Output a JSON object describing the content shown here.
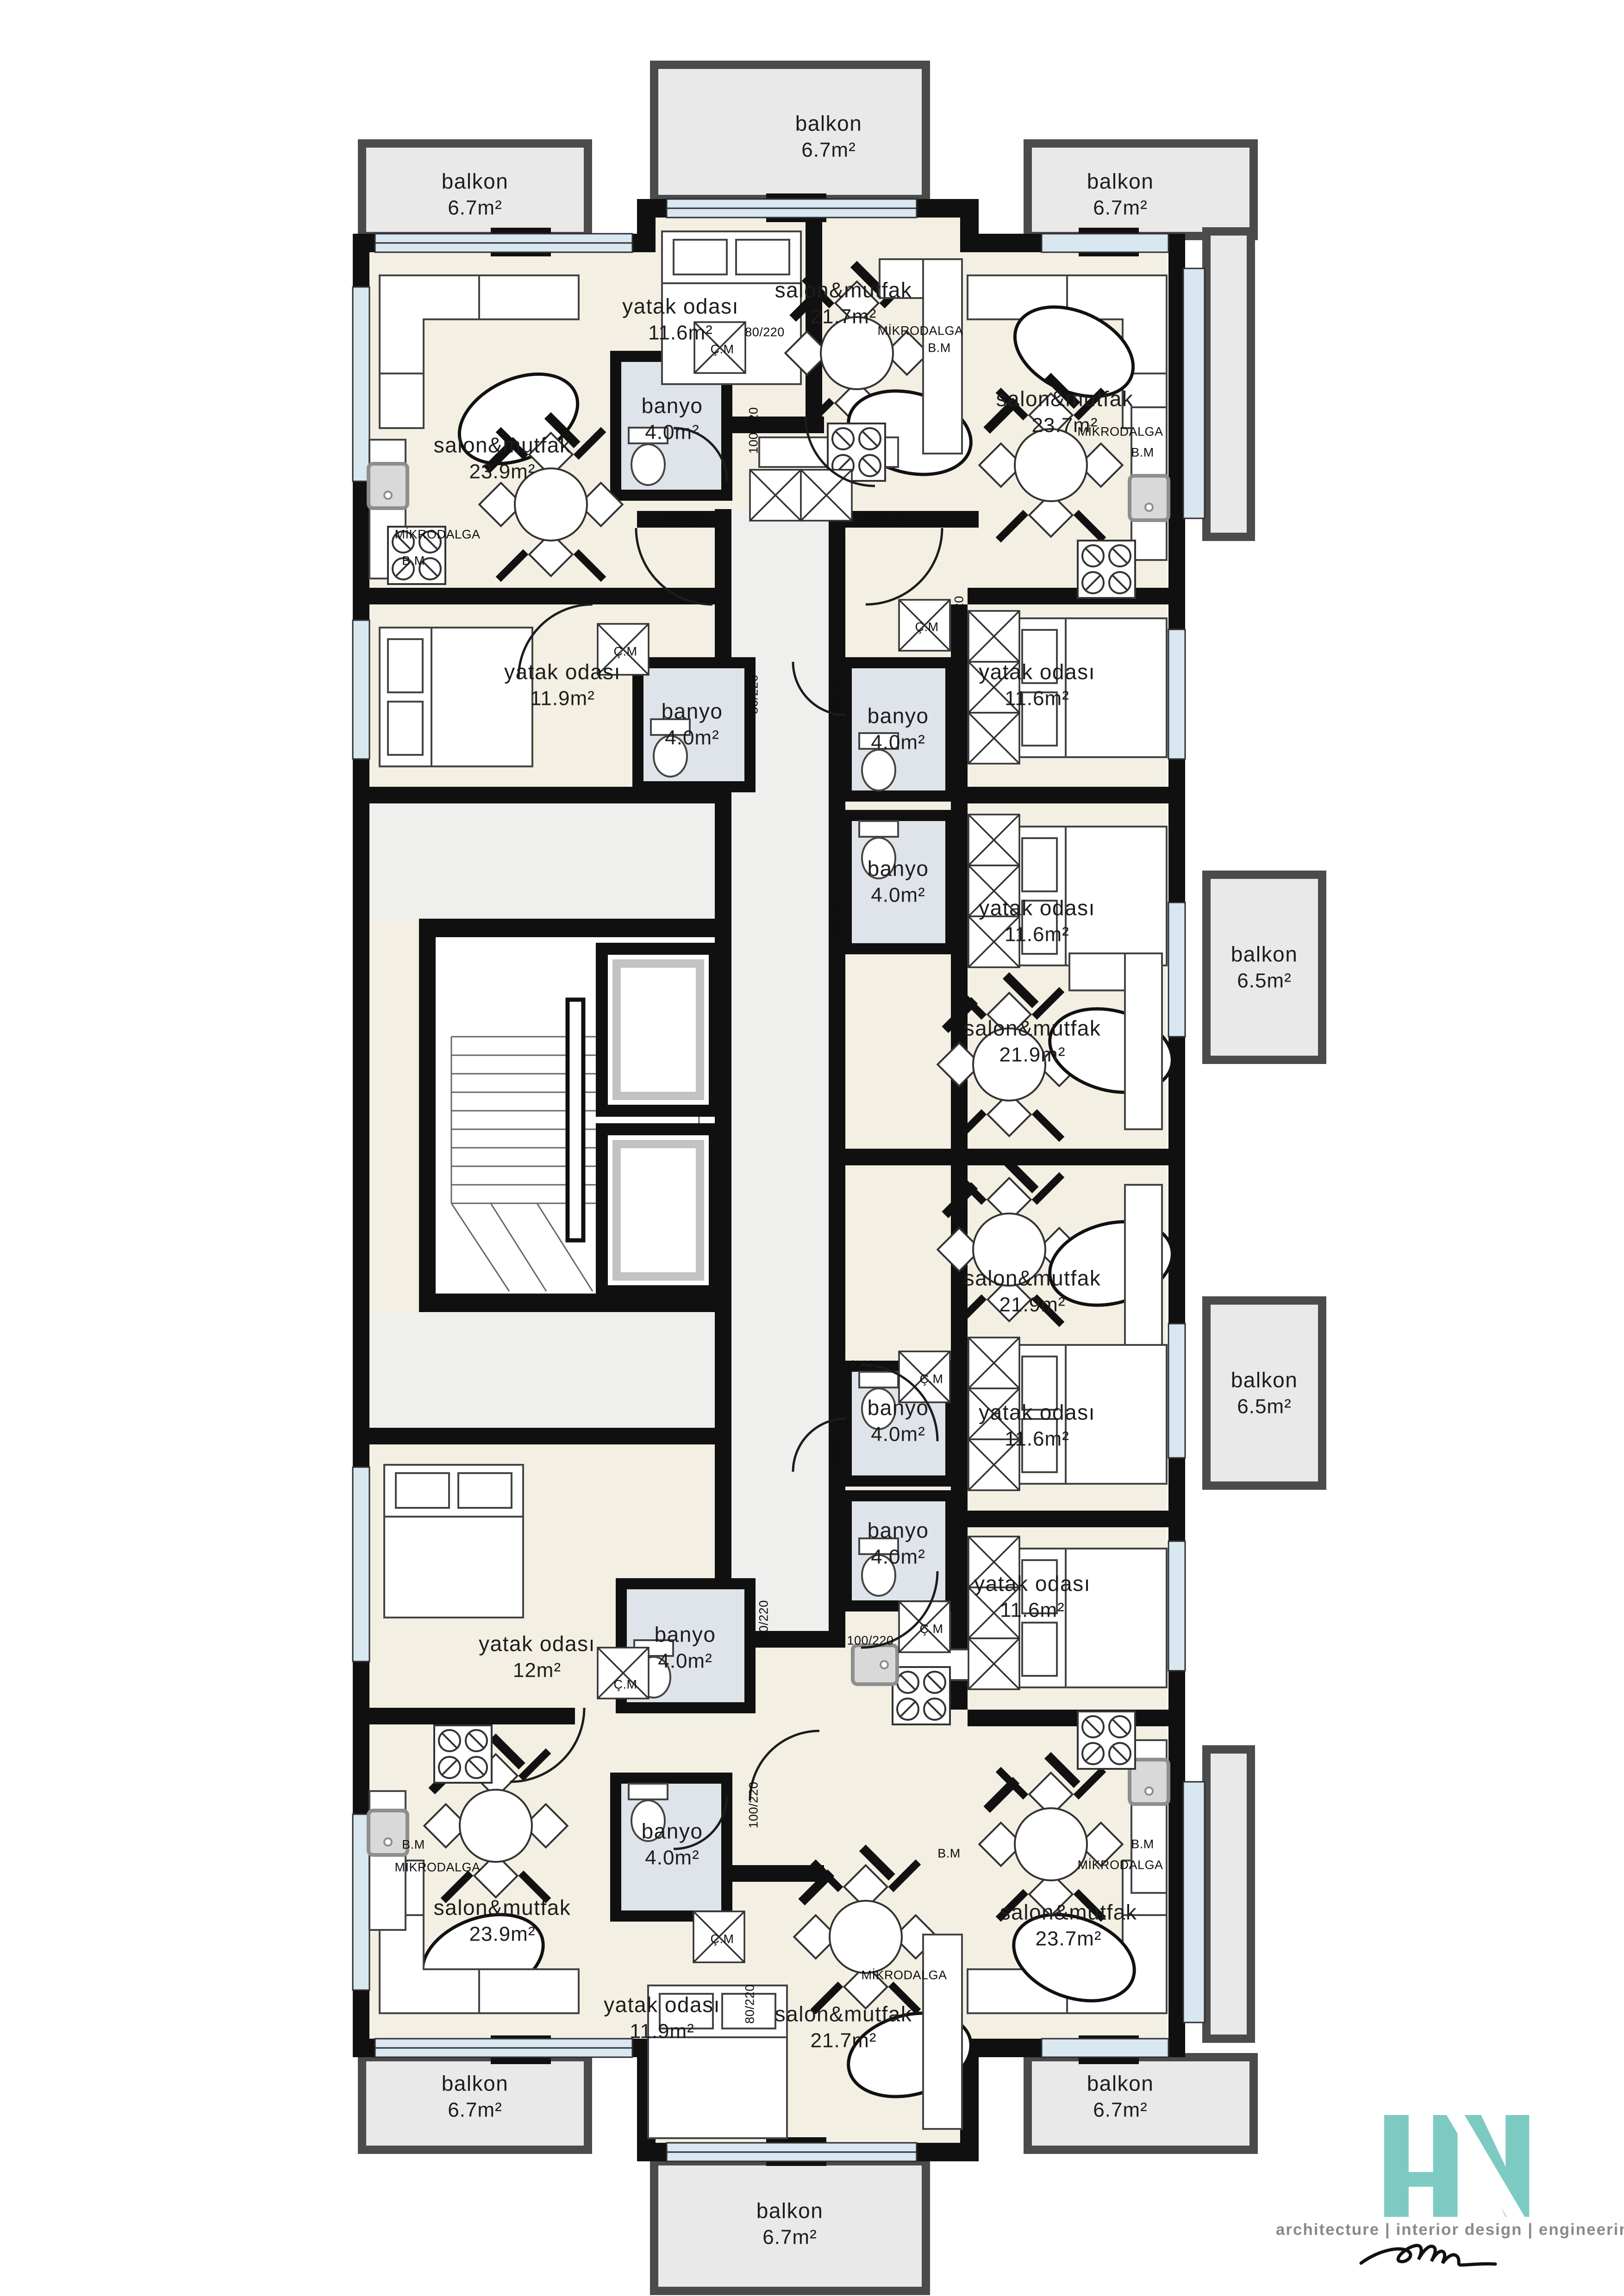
{
  "drawing": {
    "type": "apartment-floor-plan",
    "language": "Turkish",
    "room_types": {
      "salon_mutfak": "living room & kitchen",
      "yatak_odasi": "bedroom",
      "banyo": "bathroom",
      "balkon": "balcony"
    }
  },
  "palette": {
    "wall": "#101010",
    "floor_cream": "#f4efe3",
    "corridor_gray": "#efefed",
    "balcony_gray": "#e9e9e9",
    "balcony_border": "#4b4b4b",
    "bathroom_blue": "#dfe3ea",
    "window_blue": "#d9e7f1",
    "logo_teal": "#7dcac3",
    "logo_gray": "#8a8a8a"
  },
  "rooms": [
    {
      "name": "balkon",
      "area": "6.7m²"
    },
    {
      "name": "balkon",
      "area": "6.7m²"
    },
    {
      "name": "balkon",
      "area": "6.7m²"
    },
    {
      "name": "yatak odası",
      "area": "11.6m²"
    },
    {
      "name": "salon&mutfak",
      "area": "21.7m²"
    },
    {
      "name": "salon&mutfak",
      "area": "23.9m²"
    },
    {
      "name": "salon&mutfak",
      "area": "23.7m²"
    },
    {
      "name": "banyo",
      "area": "4.0m²"
    },
    {
      "name": "yatak odası",
      "area": "11.9m²"
    },
    {
      "name": "banyo",
      "area": "4.0m²"
    },
    {
      "name": "banyo",
      "area": "4.0m²"
    },
    {
      "name": "yatak odası",
      "area": "11.6m²"
    },
    {
      "name": "banyo",
      "area": "4.0m²"
    },
    {
      "name": "yatak odası",
      "area": "11.6m²"
    },
    {
      "name": "balkon",
      "area": "6.5m²"
    },
    {
      "name": "salon&mutfak",
      "area": "21.9m²"
    },
    {
      "name": "salon&mutfak",
      "area": "21.9m²"
    },
    {
      "name": "balkon",
      "area": "6.5m²"
    },
    {
      "name": "banyo",
      "area": "4.0m²"
    },
    {
      "name": "yatak odası",
      "area": "11.6m²"
    },
    {
      "name": "banyo",
      "area": "4.0m²"
    },
    {
      "name": "yatak odası",
      "area": "11.6m²"
    },
    {
      "name": "yatak odası",
      "area": "12m²"
    },
    {
      "name": "banyo",
      "area": "4.0m²"
    },
    {
      "name": "salon&mutfak",
      "area": "23.9m²"
    },
    {
      "name": "yatak odası",
      "area": "11.9m²"
    },
    {
      "name": "banyo",
      "area": "4.0m²"
    },
    {
      "name": "salon&mutfak",
      "area": "21.7m²"
    },
    {
      "name": "salon&mutfak",
      "area": "23.7m²"
    },
    {
      "name": "balkon",
      "area": "6.7m²"
    },
    {
      "name": "balkon",
      "area": "6.7m²"
    },
    {
      "name": "balkon",
      "area": "6.7m²"
    }
  ],
  "tags": [
    {
      "text": "Ç.M"
    },
    {
      "text": "MİKRODALGA"
    },
    {
      "text": "B.M"
    },
    {
      "text": "80/220"
    },
    {
      "text": "100/220"
    },
    {
      "text": "100/220"
    },
    {
      "text": "100/220"
    },
    {
      "text": "MİKRODALGA"
    },
    {
      "text": "B.M"
    },
    {
      "text": "MİKRODALGA"
    },
    {
      "text": "B.M"
    },
    {
      "text": "Ç.M"
    },
    {
      "text": "Ç.M"
    },
    {
      "text": "80/220"
    },
    {
      "text": "80/220"
    },
    {
      "text": "80/220"
    },
    {
      "text": "80/220"
    },
    {
      "text": "100/220"
    },
    {
      "text": "Ç.M"
    },
    {
      "text": "80/220"
    },
    {
      "text": "80/220"
    },
    {
      "text": "Ç.M"
    },
    {
      "text": "100/220"
    },
    {
      "text": "Ç.M"
    },
    {
      "text": "80/220"
    },
    {
      "text": "100/220"
    },
    {
      "text": "Ç.M"
    },
    {
      "text": "MİKRODALGA"
    },
    {
      "text": "B.M"
    },
    {
      "text": "MİKRODALGA"
    },
    {
      "text": "B.M"
    },
    {
      "text": "MİKRODALGA"
    },
    {
      "text": "B.M"
    },
    {
      "text": "80/220"
    }
  ],
  "logo": {
    "monogram": "HN",
    "tagline": "architecture | interior design | engineering",
    "signature": "handwritten-signature"
  }
}
